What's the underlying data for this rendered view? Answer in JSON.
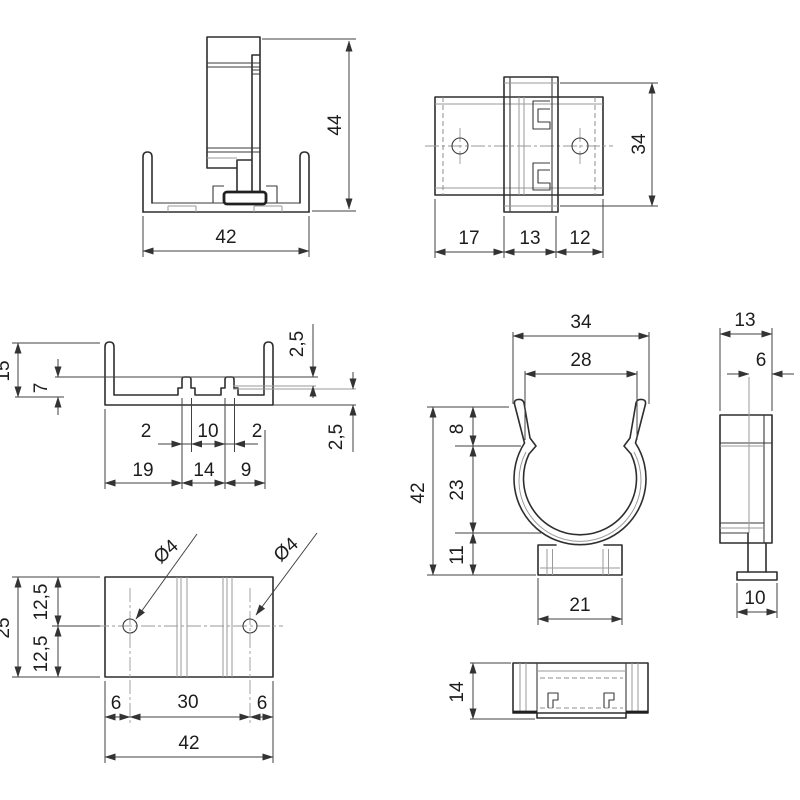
{
  "title": "pipe-clip technical drawing",
  "colors": {
    "background": "#ffffff",
    "outline": "#2e2e2e",
    "dimension": "#424242",
    "light": "#9a9a9a"
  },
  "drawing": {
    "front": {
      "width": "42",
      "height": "44"
    },
    "top": {
      "height": "34",
      "w1": "17",
      "w2": "13",
      "w3": "12"
    },
    "profile": {
      "h_total": "15",
      "h_inner": "7",
      "t_top": "2,5",
      "t_bottom": "2,5",
      "r1a": "2",
      "r1b": "10",
      "r1c": "2",
      "r2a": "19",
      "r2b": "14",
      "r2c": "9"
    },
    "clip": {
      "w_outer": "34",
      "w_inner": "28",
      "c1": "8",
      "c2": "23",
      "c3": "11",
      "h_total": "42",
      "w_base": "21"
    },
    "side": {
      "w_top": "13",
      "w_step": "6",
      "w_foot": "10"
    },
    "plan": {
      "h_total": "25",
      "h1": "12,5",
      "h2": "12,5",
      "b1": "6",
      "b2": "30",
      "b3": "6",
      "w_total": "42",
      "hole1": "Ø4",
      "hole2": "Ø4"
    },
    "small": {
      "height": "14"
    }
  }
}
